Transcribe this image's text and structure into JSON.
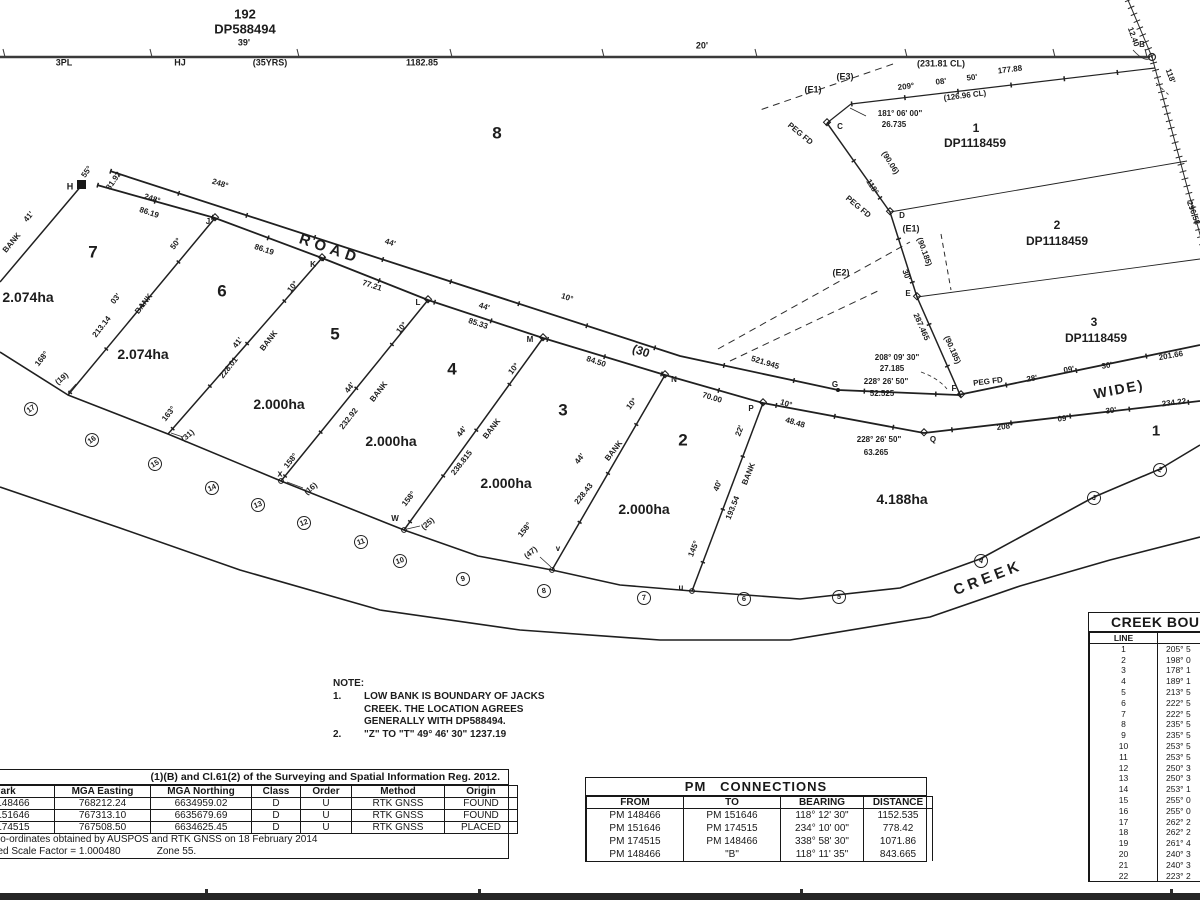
{
  "plan_meta": {
    "adjoining_parcel": {
      "lot": "192",
      "dp": "DP588494"
    },
    "creek_name": "CREEK",
    "road_width": "(30 WIDE)"
  },
  "note": {
    "heading": "NOTE:",
    "item1": {
      "no": "1.",
      "line1": "LOW BANK IS BOUNDARY  OF JACKS",
      "line2": "CREEK. THE LOCATION AGREES",
      "line3": "GENERALLY WITH DP588494."
    },
    "item2": {
      "no": "2.",
      "text": "\"Z\" TO \"T\"   49° 46' 30\"   1237.19"
    }
  },
  "labels": [
    {
      "t": "192",
      "x": 245,
      "y": 14,
      "s": 13
    },
    {
      "t": "DP588494",
      "x": 245,
      "y": 29,
      "s": 13
    },
    {
      "t": "39'",
      "x": 244,
      "y": 43,
      "s": 9
    },
    {
      "t": "3PL",
      "x": 64,
      "y": 63,
      "s": 9
    },
    {
      "t": "HJ",
      "x": 180,
      "y": 63,
      "s": 9
    },
    {
      "t": "(35YRS)",
      "x": 270,
      "y": 63,
      "s": 9
    },
    {
      "t": "1182.85",
      "x": 422,
      "y": 63,
      "s": 9
    },
    {
      "t": "20'",
      "x": 702,
      "y": 46,
      "s": 9
    },
    {
      "t": "(231.81 CL)",
      "x": 941,
      "y": 64,
      "s": 9
    },
    {
      "t": "B",
      "x": 1142,
      "y": 45,
      "s": 8
    },
    {
      "t": "12.40",
      "x": 1133,
      "y": 37,
      "s": 8,
      "r": 70
    },
    {
      "t": "118'",
      "x": 1170,
      "y": 76,
      "s": 8,
      "r": 70
    },
    {
      "t": "296.58",
      "x": 1193,
      "y": 213,
      "s": 8,
      "r": 70
    },
    {
      "t": "209°",
      "x": 906,
      "y": 87,
      "s": 8,
      "r": -7
    },
    {
      "t": "08'",
      "x": 941,
      "y": 82,
      "s": 8,
      "r": -7
    },
    {
      "t": "50'",
      "x": 972,
      "y": 78,
      "s": 8,
      "r": -7
    },
    {
      "t": "177.88",
      "x": 1010,
      "y": 70,
      "s": 8,
      "r": -7
    },
    {
      "t": "(126.96 CL)",
      "x": 965,
      "y": 96,
      "s": 8,
      "r": -7
    },
    {
      "t": "(E3)",
      "x": 845,
      "y": 77,
      "s": 9
    },
    {
      "t": "(E1)",
      "x": 813,
      "y": 90,
      "s": 9
    },
    {
      "t": "181° 06' 00\"",
      "x": 900,
      "y": 114,
      "s": 8
    },
    {
      "t": "26.735",
      "x": 894,
      "y": 125,
      "s": 8
    },
    {
      "t": "PEG FD",
      "x": 800,
      "y": 134,
      "s": 8,
      "r": 40
    },
    {
      "t": "C",
      "x": 840,
      "y": 127,
      "s": 8
    },
    {
      "t": "8",
      "x": 497,
      "y": 133,
      "s": 17,
      "w": 700
    },
    {
      "t": "1",
      "x": 976,
      "y": 128,
      "s": 12
    },
    {
      "t": "DP1118459",
      "x": 975,
      "y": 143,
      "s": 12
    },
    {
      "t": "118°",
      "x": 872,
      "y": 187,
      "s": 8,
      "r": 58
    },
    {
      "t": "(90.06)",
      "x": 890,
      "y": 163,
      "s": 8,
      "r": 58
    },
    {
      "t": "PEG FD",
      "x": 858,
      "y": 207,
      "s": 8,
      "r": 40
    },
    {
      "t": "D",
      "x": 902,
      "y": 216,
      "s": 8
    },
    {
      "t": "(E1)",
      "x": 911,
      "y": 229,
      "s": 9
    },
    {
      "t": "(90.185)",
      "x": 924,
      "y": 252,
      "s": 8,
      "r": 70
    },
    {
      "t": "30'",
      "x": 906,
      "y": 275,
      "s": 8,
      "r": 70
    },
    {
      "t": "E",
      "x": 908,
      "y": 294,
      "s": 8
    },
    {
      "t": "2",
      "x": 1057,
      "y": 225,
      "s": 12
    },
    {
      "t": "DP1118459",
      "x": 1057,
      "y": 241,
      "s": 12
    },
    {
      "t": "287.465",
      "x": 921,
      "y": 327,
      "s": 8,
      "r": 66
    },
    {
      "t": "(90.185)",
      "x": 952,
      "y": 350,
      "s": 8,
      "r": 66
    },
    {
      "t": "(E2)",
      "x": 841,
      "y": 273,
      "s": 9
    },
    {
      "t": "3",
      "x": 1094,
      "y": 322,
      "s": 12
    },
    {
      "t": "DP1118459",
      "x": 1096,
      "y": 338,
      "s": 12
    },
    {
      "t": "208° 09' 30\"",
      "x": 897,
      "y": 358,
      "s": 8
    },
    {
      "t": "27.185",
      "x": 892,
      "y": 369,
      "s": 8
    },
    {
      "t": "228° 26' 50\"",
      "x": 886,
      "y": 382,
      "s": 8
    },
    {
      "t": "52.525",
      "x": 882,
      "y": 394,
      "s": 8
    },
    {
      "t": "G",
      "x": 835,
      "y": 385,
      "s": 8
    },
    {
      "t": "PEG FD",
      "x": 988,
      "y": 382,
      "s": 8,
      "r": -7
    },
    {
      "t": "F",
      "x": 954,
      "y": 389,
      "s": 8
    },
    {
      "t": "28'",
      "x": 1032,
      "y": 379,
      "s": 8,
      "r": -10
    },
    {
      "t": "09'",
      "x": 1069,
      "y": 370,
      "s": 8,
      "r": -10
    },
    {
      "t": "30'",
      "x": 1107,
      "y": 366,
      "s": 8,
      "r": -10
    },
    {
      "t": "201.66",
      "x": 1171,
      "y": 356,
      "s": 8,
      "r": -10
    },
    {
      "t": "WIDE)",
      "x": 1119,
      "y": 389,
      "s": 14,
      "r": -11,
      "ls": 2
    },
    {
      "t": "208°",
      "x": 1005,
      "y": 427,
      "s": 8,
      "r": -7
    },
    {
      "t": "09'",
      "x": 1063,
      "y": 419,
      "s": 8,
      "r": -7
    },
    {
      "t": "30'",
      "x": 1111,
      "y": 411,
      "s": 8,
      "r": -7
    },
    {
      "t": "234.22",
      "x": 1174,
      "y": 403,
      "s": 8,
      "r": -7
    },
    {
      "t": "1",
      "x": 1156,
      "y": 431,
      "s": 15,
      "w": 700
    },
    {
      "t": "228° 26' 50\"",
      "x": 879,
      "y": 440,
      "s": 8
    },
    {
      "t": "63.265",
      "x": 876,
      "y": 453,
      "s": 8
    },
    {
      "t": "Q",
      "x": 933,
      "y": 440,
      "s": 8
    },
    {
      "t": "4.188ha",
      "x": 902,
      "y": 499,
      "s": 14,
      "w": 700
    },
    {
      "t": "H",
      "x": 70,
      "y": 187,
      "s": 9
    },
    {
      "t": "55°",
      "x": 87,
      "y": 172,
      "s": 8,
      "r": -55
    },
    {
      "t": "31.92",
      "x": 114,
      "y": 181,
      "s": 8,
      "r": -55
    },
    {
      "t": "41'",
      "x": 29,
      "y": 217,
      "s": 8,
      "r": -50
    },
    {
      "t": "BANK",
      "x": 12,
      "y": 243,
      "s": 8,
      "r": -50
    },
    {
      "t": "248°",
      "x": 220,
      "y": 184,
      "s": 8,
      "r": 18
    },
    {
      "t": "248°",
      "x": 152,
      "y": 199,
      "s": 8,
      "r": 18
    },
    {
      "t": "86.19",
      "x": 149,
      "y": 213,
      "s": 8,
      "r": 18
    },
    {
      "t": "J",
      "x": 208,
      "y": 222,
      "s": 8
    },
    {
      "t": "ROAD",
      "x": 330,
      "y": 249,
      "s": 15,
      "r": 19,
      "ls": 5,
      "w": 700
    },
    {
      "t": "86.19",
      "x": 264,
      "y": 250,
      "s": 8,
      "r": 18
    },
    {
      "t": "44'",
      "x": 390,
      "y": 243,
      "s": 8,
      "r": 18
    },
    {
      "t": "K",
      "x": 313,
      "y": 265,
      "s": 8
    },
    {
      "t": "77.21",
      "x": 372,
      "y": 286,
      "s": 8,
      "r": 18
    },
    {
      "t": "L",
      "x": 418,
      "y": 303,
      "s": 8
    },
    {
      "t": "44'",
      "x": 484,
      "y": 307,
      "s": 8,
      "r": 18
    },
    {
      "t": "85.33",
      "x": 478,
      "y": 324,
      "s": 8,
      "r": 18
    },
    {
      "t": "10°",
      "x": 567,
      "y": 298,
      "s": 8,
      "r": 18
    },
    {
      "t": "M",
      "x": 530,
      "y": 340,
      "s": 8
    },
    {
      "t": "(30",
      "x": 641,
      "y": 351,
      "s": 12,
      "r": 19
    },
    {
      "t": "84.50",
      "x": 596,
      "y": 362,
      "s": 8,
      "r": 18
    },
    {
      "t": "521.945",
      "x": 765,
      "y": 363,
      "s": 8,
      "r": 17
    },
    {
      "t": "N",
      "x": 674,
      "y": 380,
      "s": 8
    },
    {
      "t": "70.00",
      "x": 712,
      "y": 398,
      "s": 8,
      "r": 17
    },
    {
      "t": "P",
      "x": 751,
      "y": 409,
      "s": 8
    },
    {
      "t": "10°",
      "x": 786,
      "y": 404,
      "s": 8,
      "r": 17
    },
    {
      "t": "48.48",
      "x": 795,
      "y": 423,
      "s": 8,
      "r": 17
    },
    {
      "t": "7",
      "x": 93,
      "y": 252,
      "s": 17,
      "w": 700
    },
    {
      "t": "2.074ha",
      "x": 28,
      "y": 297,
      "s": 14,
      "w": 700
    },
    {
      "t": "6",
      "x": 222,
      "y": 291,
      "s": 17,
      "w": 700
    },
    {
      "t": "2.074ha",
      "x": 143,
      "y": 354,
      "s": 14,
      "w": 700
    },
    {
      "t": "5",
      "x": 335,
      "y": 334,
      "s": 17,
      "w": 700
    },
    {
      "t": "2.000ha",
      "x": 279,
      "y": 404,
      "s": 14,
      "w": 700
    },
    {
      "t": "4",
      "x": 452,
      "y": 369,
      "s": 17,
      "w": 700
    },
    {
      "t": "2.000ha",
      "x": 391,
      "y": 441,
      "s": 14,
      "w": 700
    },
    {
      "t": "3",
      "x": 563,
      "y": 410,
      "s": 17,
      "w": 700
    },
    {
      "t": "2.000ha",
      "x": 506,
      "y": 483,
      "s": 14,
      "w": 700
    },
    {
      "t": "2",
      "x": 683,
      "y": 440,
      "s": 17,
      "w": 700
    },
    {
      "t": "2.000ha",
      "x": 644,
      "y": 509,
      "s": 14,
      "w": 700
    },
    {
      "t": "50°",
      "x": 176,
      "y": 244,
      "s": 8,
      "r": -52
    },
    {
      "t": "03'",
      "x": 116,
      "y": 299,
      "s": 8,
      "r": -52
    },
    {
      "t": "BANK",
      "x": 144,
      "y": 304,
      "s": 8,
      "r": -52
    },
    {
      "t": "213.14",
      "x": 102,
      "y": 327,
      "s": 8,
      "r": -52
    },
    {
      "t": "168°",
      "x": 42,
      "y": 359,
      "s": 8,
      "r": -52
    },
    {
      "t": "(19)",
      "x": 62,
      "y": 379,
      "s": 8,
      "r": -40
    },
    {
      "t": "10°",
      "x": 293,
      "y": 287,
      "s": 8,
      "r": -52
    },
    {
      "t": "41'",
      "x": 238,
      "y": 343,
      "s": 8,
      "r": -52
    },
    {
      "t": "BANK",
      "x": 269,
      "y": 341,
      "s": 8,
      "r": -52
    },
    {
      "t": "228.01",
      "x": 229,
      "y": 368,
      "s": 8,
      "r": -52
    },
    {
      "t": "163°",
      "x": 169,
      "y": 414,
      "s": 8,
      "r": -52
    },
    {
      "t": "(31)",
      "x": 188,
      "y": 436,
      "s": 8,
      "r": -40
    },
    {
      "t": "10°",
      "x": 402,
      "y": 328,
      "s": 8,
      "r": -52
    },
    {
      "t": "44'",
      "x": 350,
      "y": 388,
      "s": 8,
      "r": -52
    },
    {
      "t": "BANK",
      "x": 379,
      "y": 392,
      "s": 8,
      "r": -52
    },
    {
      "t": "232.92",
      "x": 349,
      "y": 419,
      "s": 8,
      "r": -52
    },
    {
      "t": "158°",
      "x": 291,
      "y": 461,
      "s": 8,
      "r": -52
    },
    {
      "t": "x",
      "x": 280,
      "y": 474,
      "s": 9
    },
    {
      "t": "(16)",
      "x": 311,
      "y": 489,
      "s": 8,
      "r": -40
    },
    {
      "t": "10°",
      "x": 514,
      "y": 369,
      "s": 8,
      "r": -52
    },
    {
      "t": "44'",
      "x": 462,
      "y": 432,
      "s": 8,
      "r": -52
    },
    {
      "t": "BANK",
      "x": 492,
      "y": 429,
      "s": 8,
      "r": -52
    },
    {
      "t": "238.815",
      "x": 462,
      "y": 463,
      "s": 8,
      "r": -52
    },
    {
      "t": "158°",
      "x": 409,
      "y": 499,
      "s": 8,
      "r": -52
    },
    {
      "t": "W",
      "x": 395,
      "y": 519,
      "s": 8
    },
    {
      "t": "(25)",
      "x": 428,
      "y": 524,
      "s": 8,
      "r": -40
    },
    {
      "t": "10°",
      "x": 632,
      "y": 404,
      "s": 8,
      "r": -52
    },
    {
      "t": "44'",
      "x": 580,
      "y": 459,
      "s": 8,
      "r": -52
    },
    {
      "t": "BANK",
      "x": 614,
      "y": 451,
      "s": 8,
      "r": -52
    },
    {
      "t": "228.43",
      "x": 584,
      "y": 494,
      "s": 8,
      "r": -52
    },
    {
      "t": "158°",
      "x": 525,
      "y": 530,
      "s": 8,
      "r": -52
    },
    {
      "t": "v",
      "x": 558,
      "y": 549,
      "s": 8
    },
    {
      "t": "(47)",
      "x": 531,
      "y": 553,
      "s": 8,
      "r": -40
    },
    {
      "t": "22'",
      "x": 740,
      "y": 431,
      "s": 8,
      "r": -68
    },
    {
      "t": "40'",
      "x": 718,
      "y": 486,
      "s": 8,
      "r": -68
    },
    {
      "t": "BANK",
      "x": 749,
      "y": 474,
      "s": 8,
      "r": -68
    },
    {
      "t": "193.54",
      "x": 733,
      "y": 508,
      "s": 8,
      "r": -68
    },
    {
      "t": "145°",
      "x": 694,
      "y": 549,
      "s": 8,
      "r": -68
    },
    {
      "t": "u",
      "x": 681,
      "y": 588,
      "s": 8
    },
    {
      "t": "CREEK",
      "x": 988,
      "y": 578,
      "s": 15,
      "r": -21,
      "ls": 4,
      "w": 700
    },
    {
      "t": "17",
      "x": 31,
      "y": 409,
      "c": 1,
      "r": -35
    },
    {
      "t": "16",
      "x": 92,
      "y": 440,
      "c": 1,
      "r": -35
    },
    {
      "t": "15",
      "x": 155,
      "y": 464,
      "c": 1,
      "r": -30
    },
    {
      "t": "14",
      "x": 212,
      "y": 488,
      "c": 1,
      "r": -25
    },
    {
      "t": "13",
      "x": 258,
      "y": 505,
      "c": 1,
      "r": -22
    },
    {
      "t": "12",
      "x": 304,
      "y": 523,
      "c": 1,
      "r": -20
    },
    {
      "t": "11",
      "x": 361,
      "y": 542,
      "c": 1,
      "r": -18
    },
    {
      "t": "10",
      "x": 400,
      "y": 561,
      "c": 1,
      "r": -18
    },
    {
      "t": "9",
      "x": 463,
      "y": 579,
      "c": 1,
      "r": -15
    },
    {
      "t": "8",
      "x": 544,
      "y": 591,
      "c": 1,
      "r": -10
    },
    {
      "t": "7",
      "x": 644,
      "y": 598,
      "c": 1,
      "r": -5
    },
    {
      "t": "6",
      "x": 744,
      "y": 599,
      "c": 1,
      "r": 0
    },
    {
      "t": "5",
      "x": 839,
      "y": 597,
      "c": 1,
      "r": 5
    },
    {
      "t": "4",
      "x": 981,
      "y": 561,
      "c": 1,
      "r": 20
    },
    {
      "t": "3",
      "x": 1094,
      "y": 498,
      "c": 1,
      "r": 28
    },
    {
      "t": "2",
      "x": 1160,
      "y": 470,
      "c": 1,
      "r": 25
    }
  ],
  "tables": {
    "survey_marks": {
      "x": -48,
      "y": 769,
      "w": 557,
      "title": "(1)(B) and Cl.61(2) of the Surveying and Spatial Information Reg. 2012.",
      "title_right": 8,
      "title_size": 10.5,
      "title_weight": 600,
      "font": 10,
      "row_h": 12,
      "grid": true,
      "columns": [
        {
          "label": "Mark",
          "w": 100
        },
        {
          "label": "MGA Easting",
          "w": 95
        },
        {
          "label": "MGA Northing",
          "w": 100
        },
        {
          "label": "Class",
          "w": 48
        },
        {
          "label": "Order",
          "w": 50
        },
        {
          "label": "Method",
          "w": 92
        },
        {
          "label": "Origin",
          "w": 72
        }
      ],
      "rows": [
        [
          "PM 148466",
          "768212.24",
          "6634959.02",
          "D",
          "U",
          "RTK GNSS",
          "FOUND"
        ],
        [
          "PM 151646",
          "767313.10",
          "6635679.69",
          "D",
          "U",
          "RTK GNSS",
          "FOUND"
        ],
        [
          "PM 174515",
          "767508.50",
          "6634625.45",
          "D",
          "U",
          "RTK GNSS",
          "PLACED"
        ]
      ],
      "footers": [
        {
          "text": "Co-ordinates obtained by AUSPOS and RTK GNSS on 18 February 2014",
          "pad": 40
        },
        {
          "text": "Combined Scale Factor = 1.000480             Zone 55.",
          "pad": 10
        }
      ]
    },
    "pm_connections": {
      "x": 585,
      "y": 777,
      "w": 342,
      "title": "PM   CONNECTIONS",
      "title_size": 13,
      "font": 10,
      "row_h": 13,
      "grid": false,
      "columns": [
        {
          "label": "FROM",
          "w": 96
        },
        {
          "label": "TO",
          "w": 96
        },
        {
          "label": "BEARING",
          "w": 82
        },
        {
          "label": "DISTANCE",
          "w": 68
        }
      ],
      "rows": [
        [
          "PM 148466",
          "PM 151646",
          "118° 12' 30\"",
          "1152.535"
        ],
        [
          "PM 151646",
          "PM 174515",
          "234° 10' 00\"",
          "778.42"
        ],
        [
          "PM 174515",
          "PM 148466",
          "338° 58' 30\"",
          "1071.86"
        ],
        [
          "PM 148466",
          "\"B\"",
          "118° 11' 35\"",
          "843.665"
        ]
      ]
    },
    "creek_boundary": {
      "x": 1088,
      "y": 612,
      "w": 190,
      "title": "CREEK BOUNDARY",
      "title_pad": 22,
      "title_size": 14,
      "font": 8.5,
      "row_h": 10.8,
      "grid": false,
      "cell_align": [
        "c",
        "l"
      ],
      "columns": [
        {
          "label": "LINE",
          "w": 67
        },
        {
          "label": "BEARING",
          "w": 123
        }
      ],
      "rows": [
        [
          "1",
          "205° 5"
        ],
        [
          "2",
          "198° 0"
        ],
        [
          "3",
          "178° 1"
        ],
        [
          "4",
          "189° 1"
        ],
        [
          "5",
          "213° 5"
        ],
        [
          "6",
          "222° 5"
        ],
        [
          "7",
          "222° 5"
        ],
        [
          "8",
          "235° 5"
        ],
        [
          "9",
          "235° 5"
        ],
        [
          "10",
          "253° 5"
        ],
        [
          "11",
          "253° 5"
        ],
        [
          "12",
          "250° 3"
        ],
        [
          "13",
          "250° 3"
        ],
        [
          "14",
          "253° 1"
        ],
        [
          "15",
          "255° 0"
        ],
        [
          "16",
          "255° 0"
        ],
        [
          "17",
          "262° 2"
        ],
        [
          "18",
          "262° 2"
        ],
        [
          "19",
          "261° 4"
        ],
        [
          "20",
          "240° 3"
        ],
        [
          "21",
          "240° 3"
        ],
        [
          "22",
          "223° 2"
        ]
      ]
    }
  }
}
